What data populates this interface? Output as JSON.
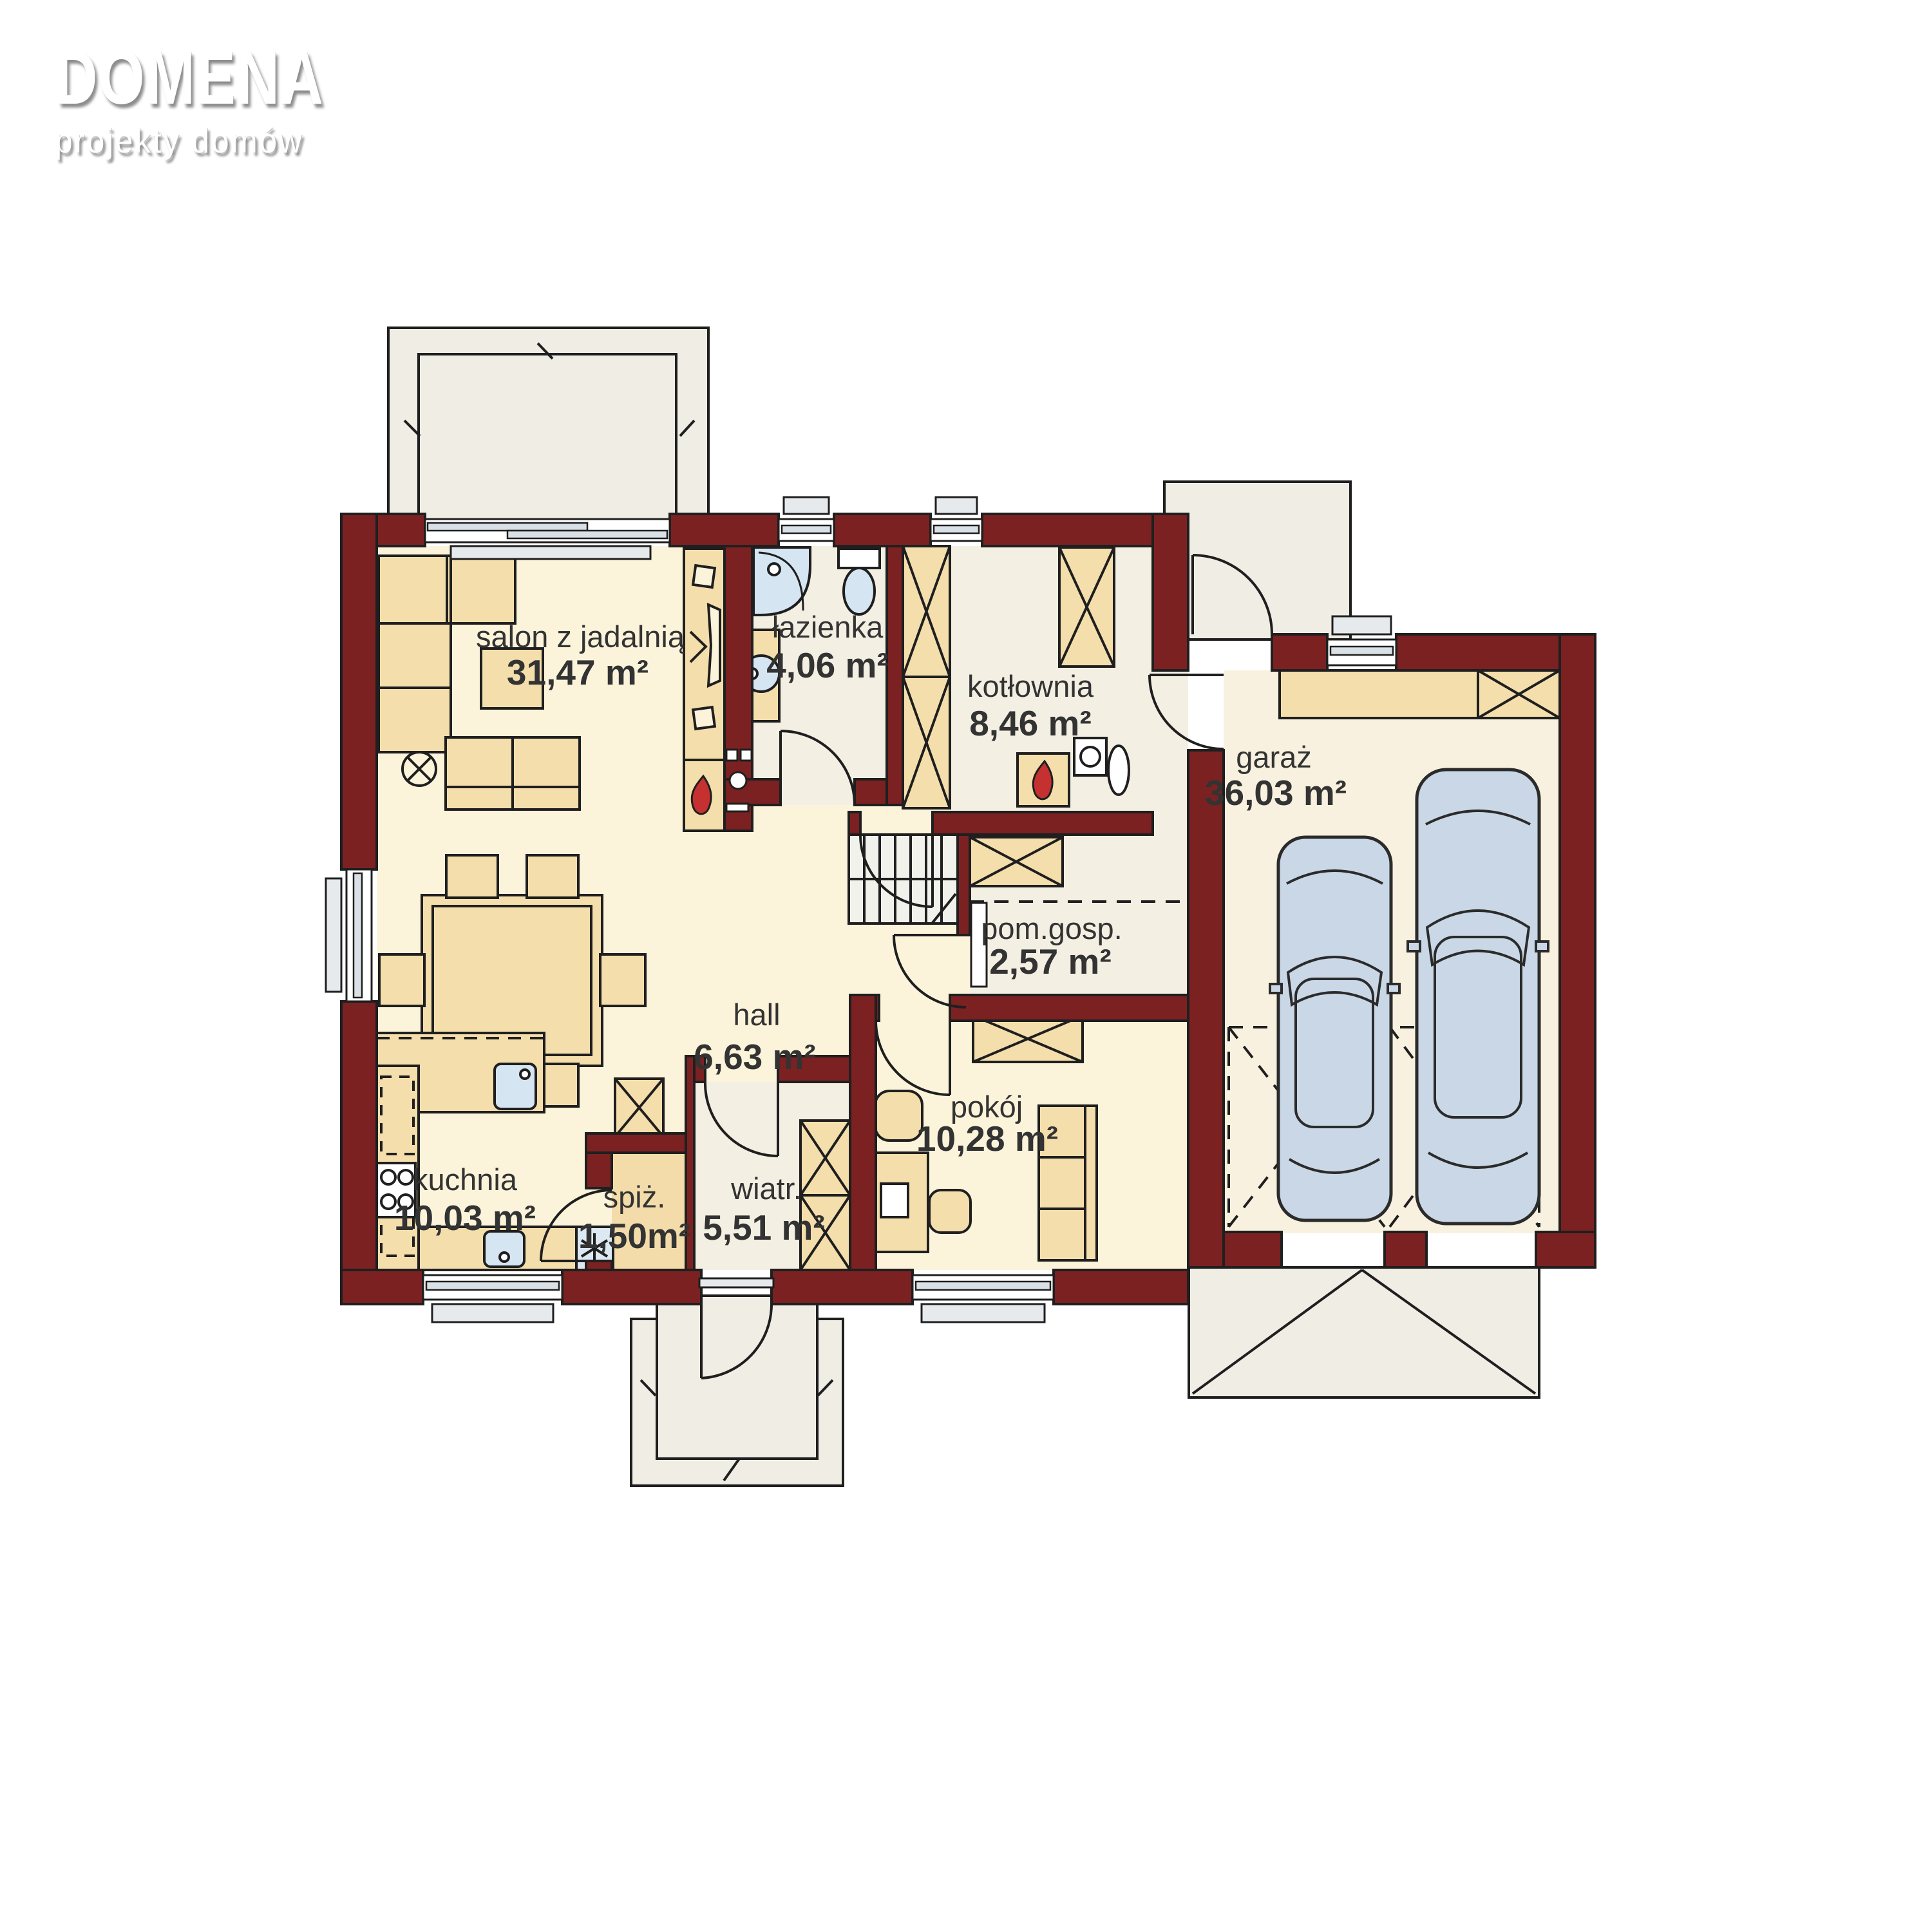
{
  "logo": {
    "brand": "DOMENA",
    "tagline": "projekty domów"
  },
  "plan": {
    "rooms": [
      {
        "id": "salon",
        "name": "salon z jadalnią",
        "area": "31,47 m²"
      },
      {
        "id": "lazienka",
        "name": "łazienka",
        "area": "4,06 m²"
      },
      {
        "id": "kotlownia",
        "name": "kotłownia",
        "area": "8,46 m²"
      },
      {
        "id": "garaz",
        "name": "garaż",
        "area": "36,03 m²"
      },
      {
        "id": "pom_gosp",
        "name": "pom.gosp.",
        "area": "2,57 m²"
      },
      {
        "id": "hall",
        "name": "hall",
        "area": "6,63 m²"
      },
      {
        "id": "pokoj",
        "name": "pokój",
        "area": "10,28 m²"
      },
      {
        "id": "kuchnia",
        "name": "kuchnia",
        "area": "10,03 m²"
      },
      {
        "id": "spiz",
        "name": "spiż.",
        "area": "1,50m²"
      },
      {
        "id": "wiatr",
        "name": "wiatr.",
        "area": "5,51 m²"
      }
    ],
    "colors": {
      "wall": "#7B2121",
      "floor_living": "#FBF4DB",
      "floor_service": "#F4EFE3",
      "floor_garage": "#F8F1DF",
      "terrace": "#F0EDE5",
      "furniture": "#F4DEAC",
      "fixture_blue": "#D6E5F2",
      "car_blue": "#C9D7E6",
      "flame_red": "#C53030",
      "outline": "#1F1F1F",
      "text": "#333333"
    }
  }
}
